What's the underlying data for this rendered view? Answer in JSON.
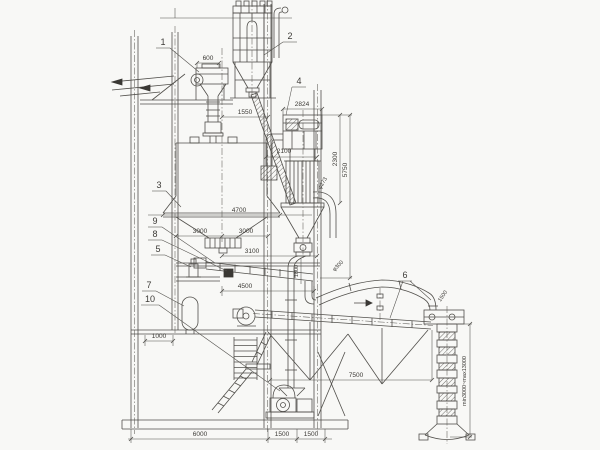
{
  "callouts": {
    "c1": "1",
    "c2": "2",
    "c3": "3",
    "c4": "4",
    "c5": "5",
    "c6": "6",
    "c7": "7",
    "c8": "8",
    "c9": "9",
    "c10": "10"
  },
  "dims": {
    "d600": "600",
    "d1550": "1550",
    "d2824": "2824",
    "d2100": "2100",
    "d2300": "2300",
    "d5750": "5750",
    "d4700": "4700",
    "d3000a": "3000",
    "d3000b": "3000",
    "d3100": "3100",
    "d4500": "4500",
    "d1800": "1800",
    "d1000": "1000",
    "d7500": "7500",
    "d6000": "6000",
    "d1500a": "1500",
    "d1500b": "1500",
    "spout_range": "min3000~max13000"
  },
  "pipe_labels": {
    "dia273": "φ273",
    "dia300": "φ300",
    "len1500": "1500"
  },
  "colors": {
    "line": "#514f4b",
    "text": "#3c3a36",
    "background": "#f8f8f6"
  }
}
